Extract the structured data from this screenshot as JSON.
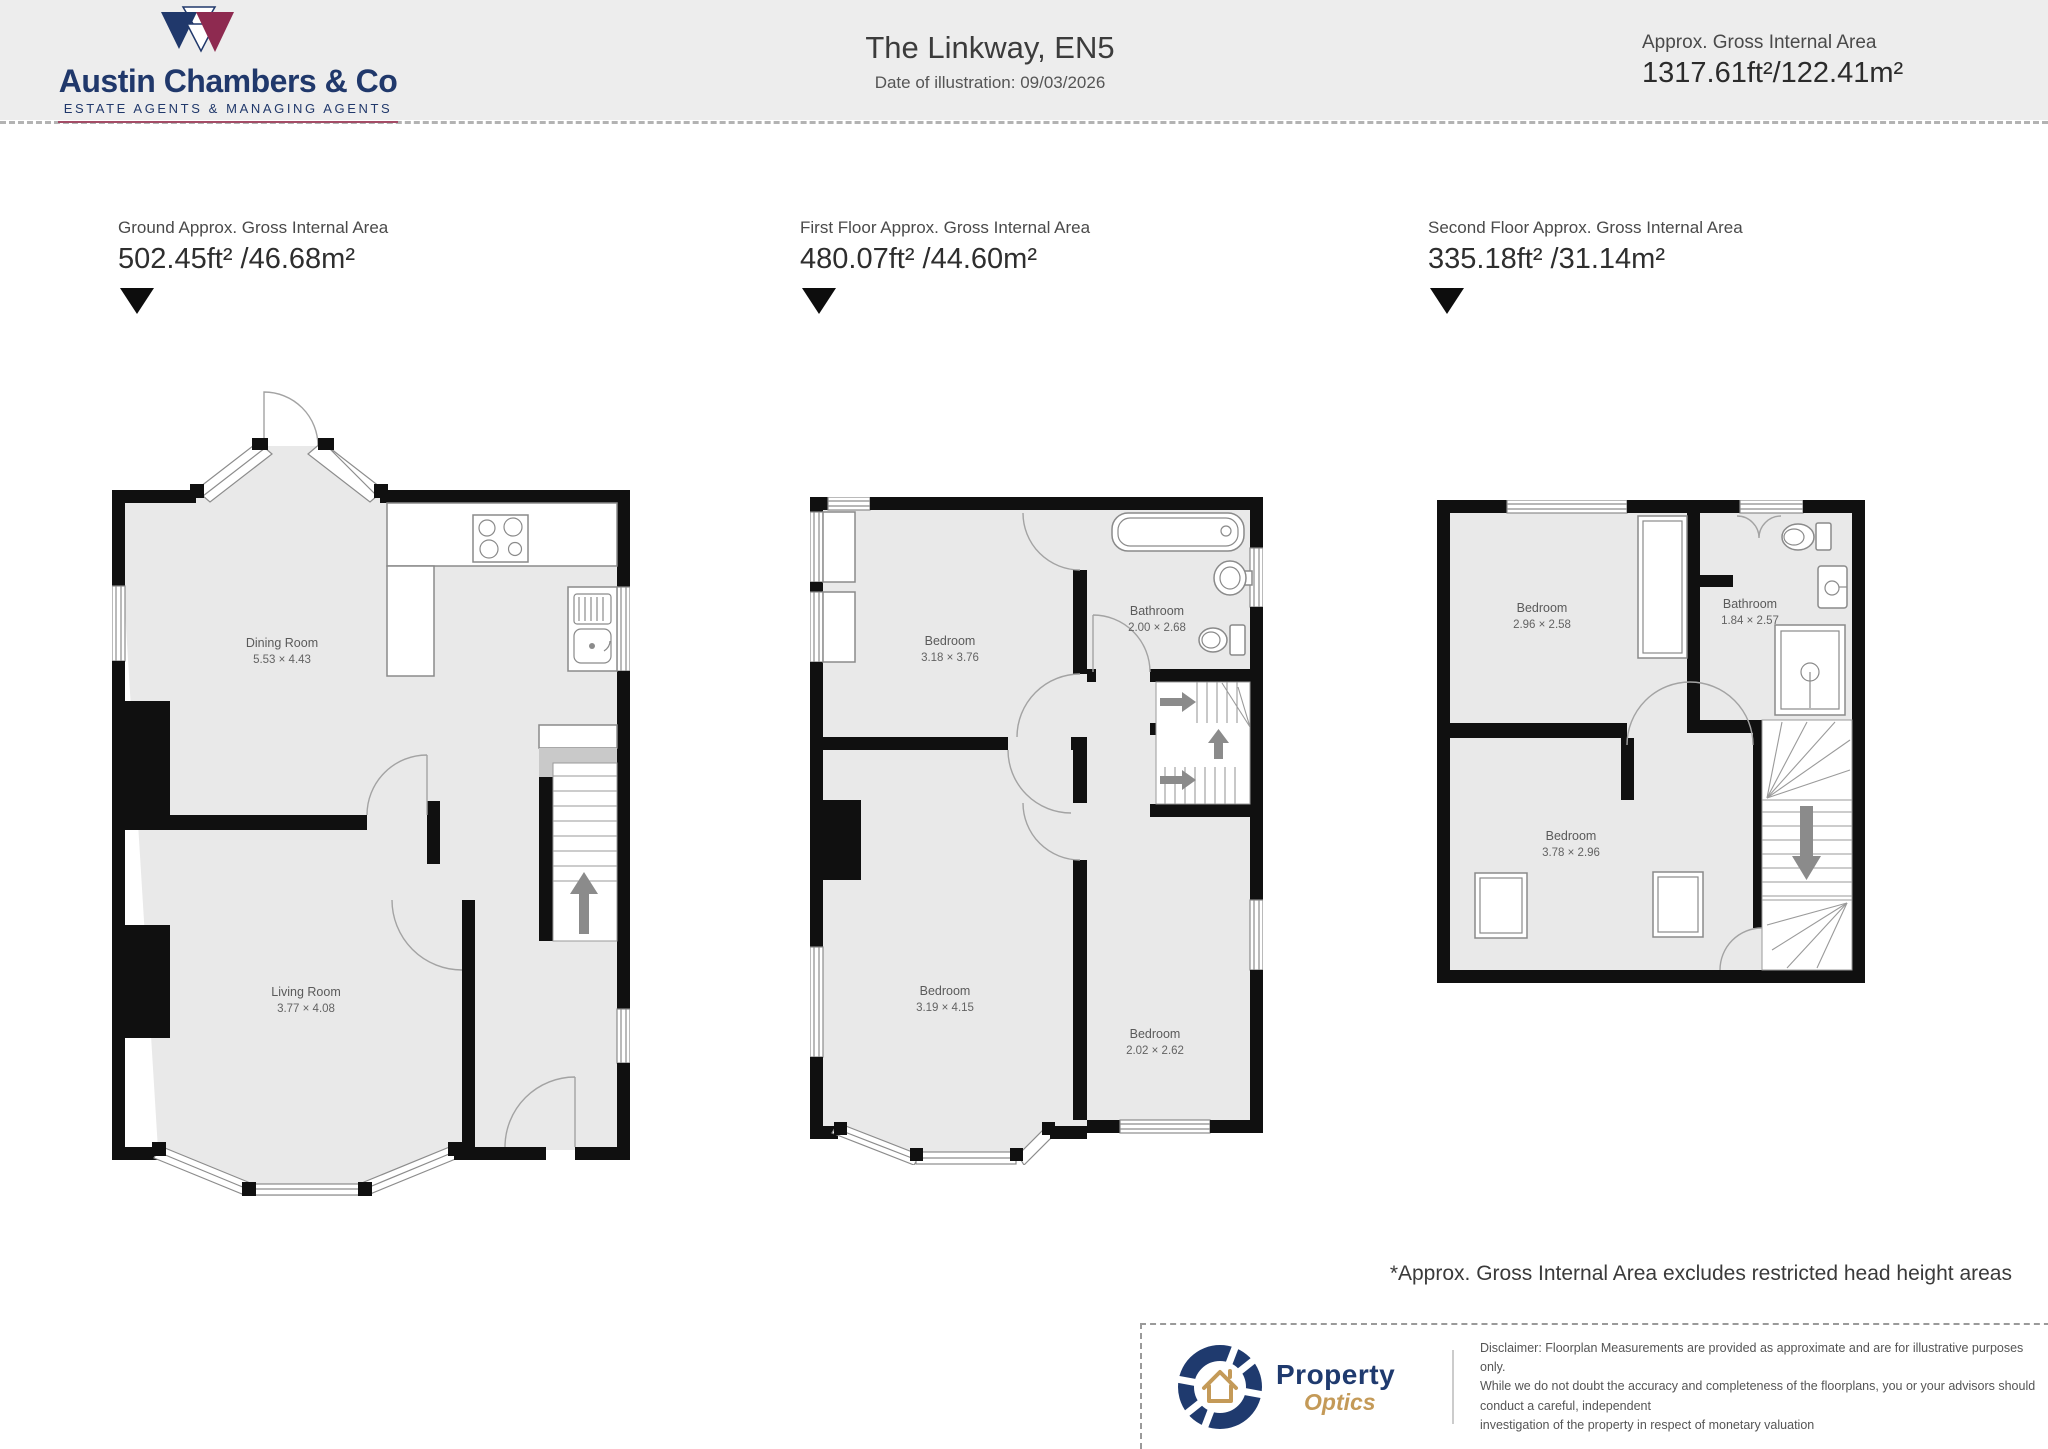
{
  "header": {
    "logo": {
      "name": "Austin Chambers & Co",
      "tagline": "ESTATE AGENTS & MANAGING AGENTS"
    },
    "title": "The Linkway, EN5",
    "date_line": "Date of illustration: 09/03/2026",
    "gia_label": "Approx. Gross Internal Area",
    "gia_value": "1317.61ft²/122.41m²"
  },
  "floors": [
    {
      "label": "Ground Approx. Gross Internal Area",
      "area": "502.45ft² /46.68m²",
      "rooms": [
        {
          "name": "Dining Room",
          "dims": "5.53 × 4.43"
        },
        {
          "name": "Living Room",
          "dims": "3.77 × 4.08"
        }
      ]
    },
    {
      "label": "First Floor Approx. Gross Internal Area",
      "area": "480.07ft² /44.60m²",
      "rooms": [
        {
          "name": "Bedroom",
          "dims": "3.18 × 3.76"
        },
        {
          "name": "Bathroom",
          "dims": "2.00 × 2.68"
        },
        {
          "name": "Bedroom",
          "dims": "3.19 × 4.15"
        },
        {
          "name": "Bedroom",
          "dims": "2.02 × 2.62"
        }
      ]
    },
    {
      "label": "Second Floor Approx. Gross Internal Area",
      "area": "335.18ft² /31.14m²",
      "rooms": [
        {
          "name": "Bedroom",
          "dims": "2.96 × 2.58"
        },
        {
          "name": "Bathroom",
          "dims": "1.84 × 2.57"
        },
        {
          "name": "Bedroom",
          "dims": "3.78 × 2.96"
        }
      ]
    }
  ],
  "footer": {
    "note": "*Approx. Gross Internal Area excludes restricted head height areas",
    "brand": {
      "line1": "Property",
      "line2": "Optics"
    },
    "disclaimer": {
      "line1": "Disclaimer: Floorplan Measurements are provided as approximate and are for illustrative purposes only.",
      "line2": "While we do not doubt the accuracy and completeness of the floorplans, you or your advisors should conduct a careful, independent",
      "line3": "investigation of the property in respect of monetary valuation"
    }
  },
  "colors": {
    "header_bg": "#ededed",
    "logo_navy": "#20386b",
    "logo_maroon": "#8e2a50",
    "floor_fill": "#e9e9e9",
    "wall": "#101010",
    "brand_navy": "#1f3a6e",
    "brand_gold": "#c49a58"
  }
}
